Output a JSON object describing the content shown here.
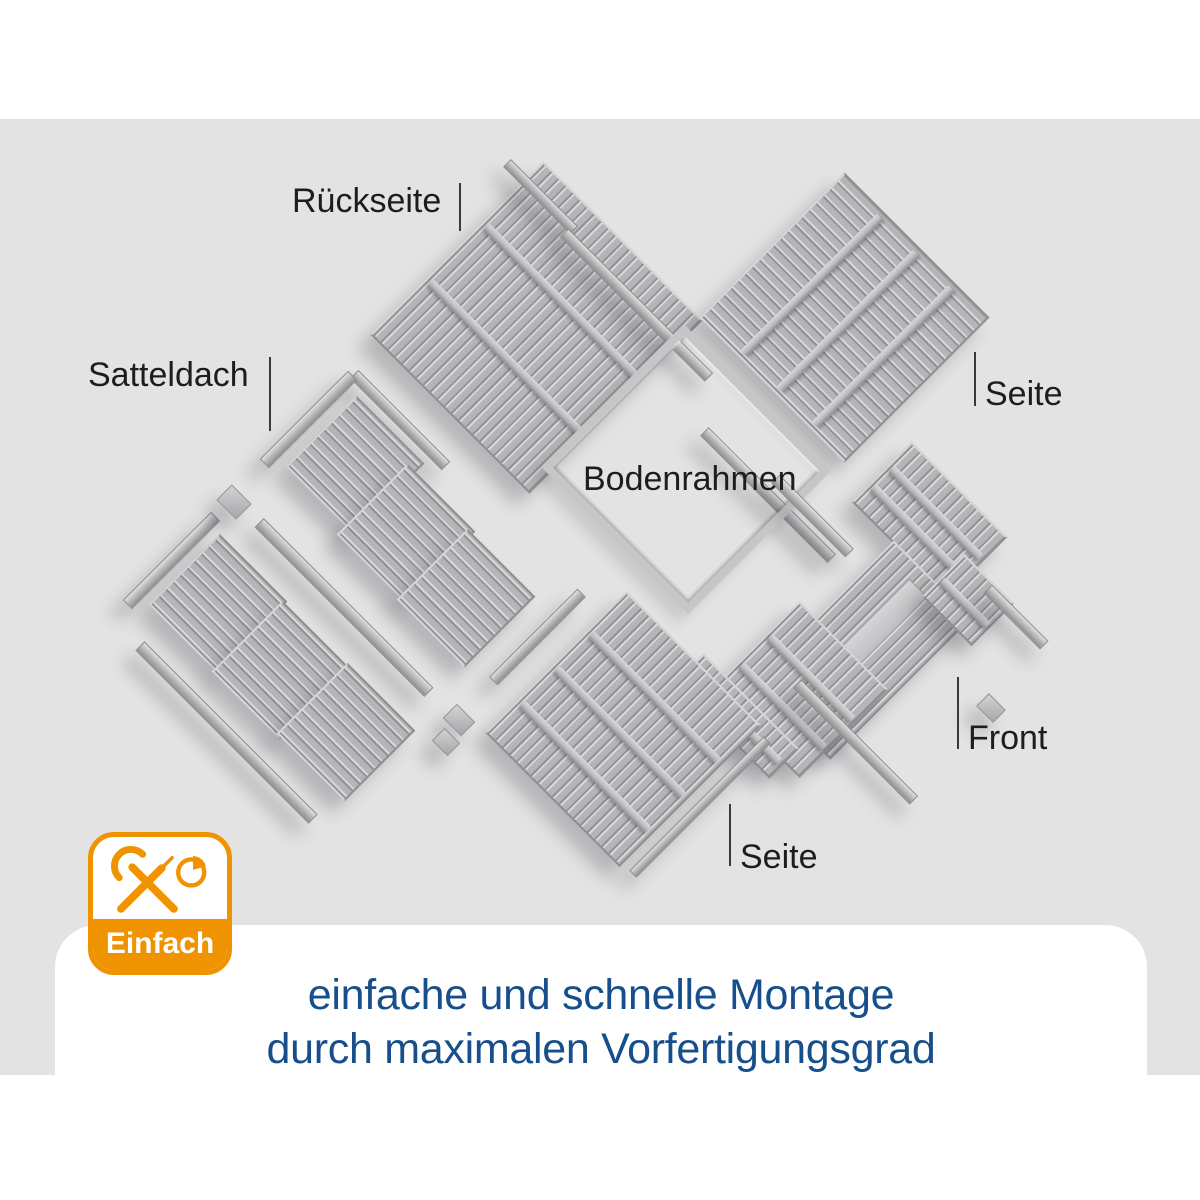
{
  "labels": {
    "rueckseite": "Rückseite",
    "satteldach": "Satteldach",
    "bodenrahmen": "Bodenrahmen",
    "seite_right": "Seite",
    "seite_bottom": "Seite",
    "front": "Front"
  },
  "badge": {
    "label": "Einfach",
    "icons": [
      "wrench-icon",
      "screwdriver-icon",
      "pie-chart-clock-icon"
    ]
  },
  "caption": {
    "line1": "einfache und schnelle Montage",
    "line2": "durch maximalen Vorfertigungsgrad"
  },
  "colors": {
    "accent_orange": "#F09300",
    "caption_blue": "#174F8C",
    "label_text": "#1D1D1B",
    "background_gray": "#E3E3E4",
    "panel_base": "#B5B5B7"
  }
}
